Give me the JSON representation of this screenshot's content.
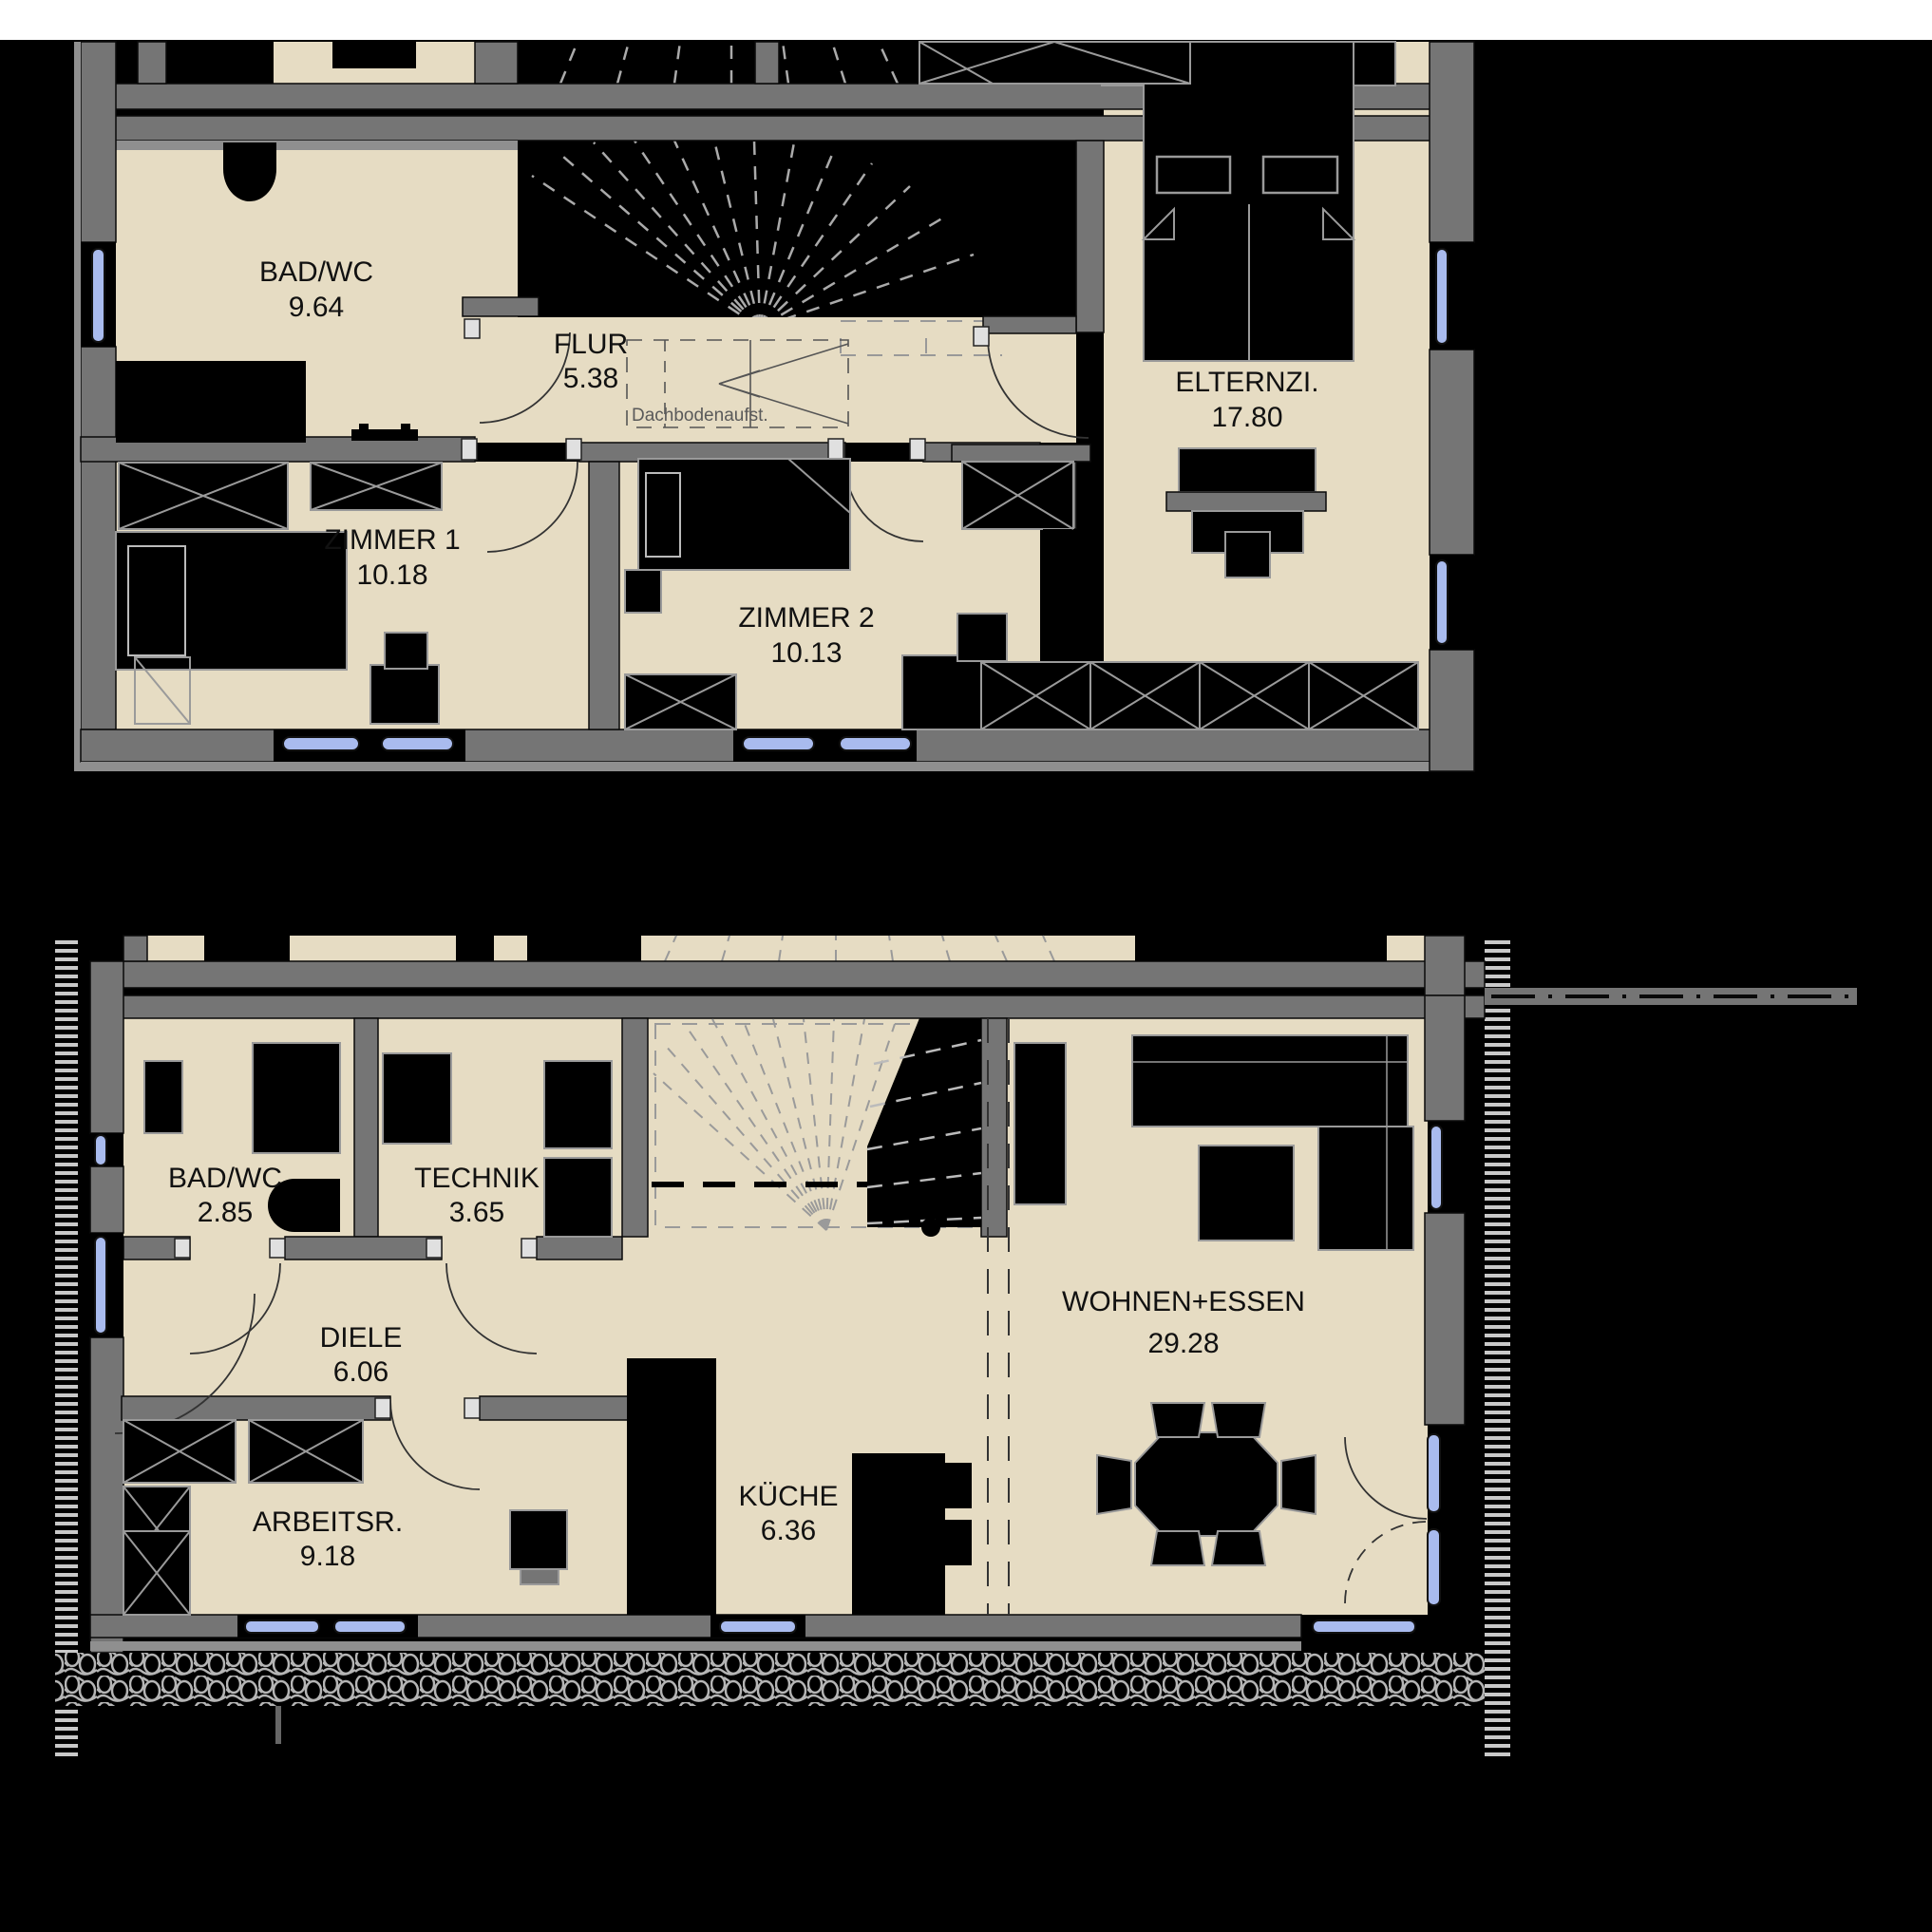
{
  "document": {
    "type": "architectural floor plan, two storeys",
    "background_color": "#000000",
    "page_top_color": "#ffffff"
  },
  "colors": {
    "floor": "#e6dcc3",
    "wall": "#757575",
    "wall_light": "#8f8f8f",
    "furniture": "#000000",
    "outline": "#9a9a9a",
    "window_glass": "#a9bbee",
    "hatch": "#b5b5b5",
    "stair_dash": "#aaaaaa",
    "label_text": "#111111",
    "annotation_text": "#5a5a5a"
  },
  "floors": {
    "upper": {
      "title": "upper-floor-plan",
      "annotation": "Dachbodenaufst.",
      "rooms": [
        {
          "id": "bad-wc-og",
          "name": "BAD/WC",
          "area": "9.64"
        },
        {
          "id": "flur",
          "name": "FLUR",
          "area": "5.38"
        },
        {
          "id": "elternzimmer",
          "name": "ELTERNZI.",
          "area": "17.80"
        },
        {
          "id": "zimmer-1",
          "name": "ZIMMER 1",
          "area": "10.18"
        },
        {
          "id": "zimmer-2",
          "name": "ZIMMER 2",
          "area": "10.13"
        }
      ]
    },
    "ground": {
      "title": "ground-floor-plan",
      "rooms": [
        {
          "id": "bad-wc-eg",
          "name": "BAD/WC",
          "area": "2.85"
        },
        {
          "id": "technik",
          "name": "TECHNIK",
          "area": "3.65"
        },
        {
          "id": "diele",
          "name": "DIELE",
          "area": "6.06"
        },
        {
          "id": "arbeitsraum",
          "name": "ARBEITSR.",
          "area": "9.18"
        },
        {
          "id": "kueche",
          "name": "KÜCHE",
          "area": "6.36"
        },
        {
          "id": "wohnen-essen",
          "name": "WOHNEN+ESSEN",
          "area": "29.28"
        }
      ]
    }
  }
}
